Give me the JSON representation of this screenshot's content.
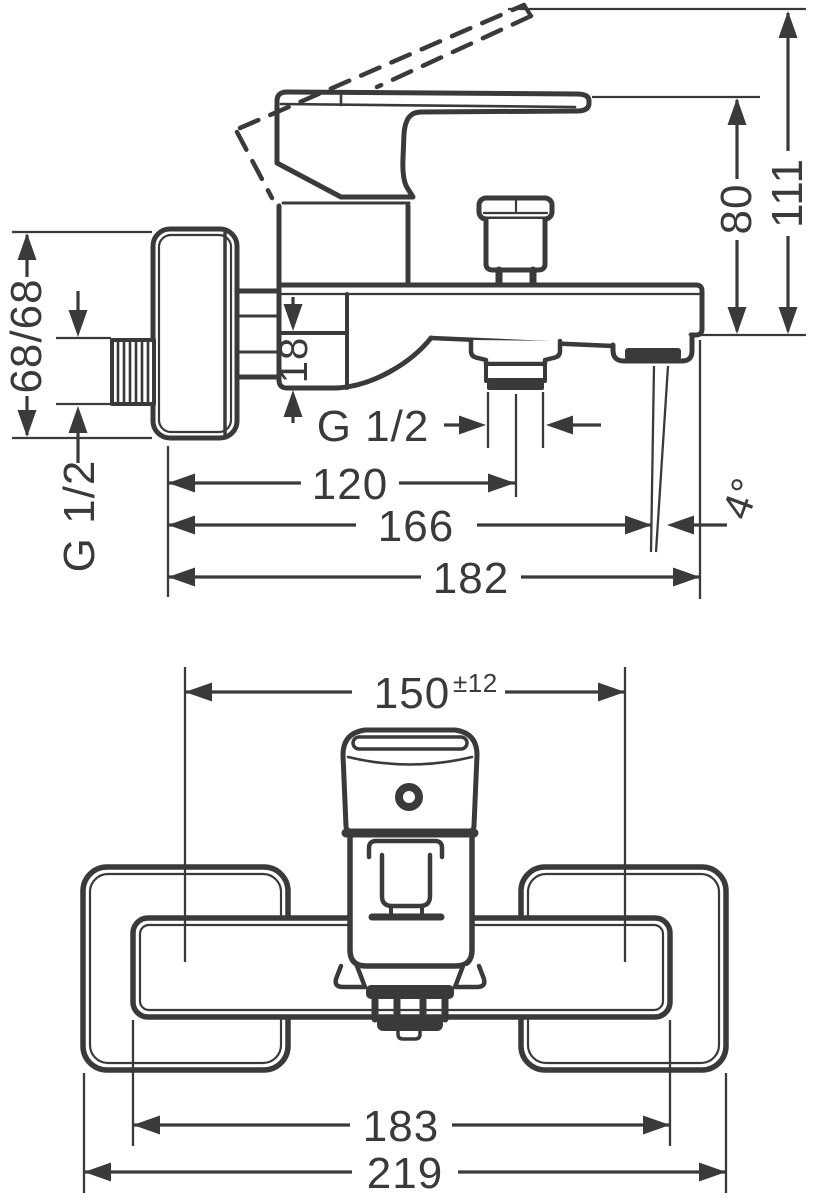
{
  "side_view": {
    "total_height": "111",
    "handle_height": "80",
    "escutcheon_size": "68/68",
    "wall_connection_thread": "G 1/2",
    "body_drop": "18",
    "shower_hose_thread": "G 1/2",
    "depth_hose_outlet": "120",
    "depth_spout_outlet": "166",
    "depth_total": "182",
    "spout_angle": "4°"
  },
  "front_view": {
    "connection_distance": "150",
    "connection_tolerance": "±12",
    "body_width": "183",
    "overall_width": "219"
  },
  "colors": {
    "line": "#3a3a3a",
    "background": "#ffffff"
  }
}
